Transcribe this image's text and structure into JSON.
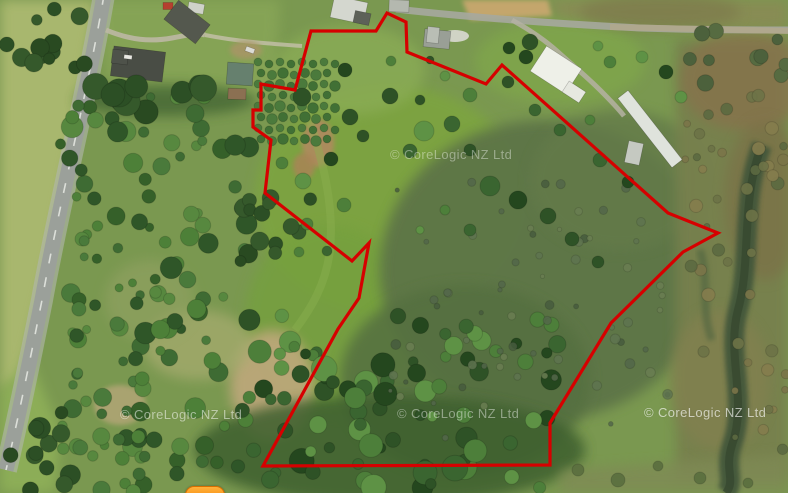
{
  "watermark": {
    "text": "© CoreLogic NZ Ltd"
  },
  "boundary": {
    "color": "#d60000",
    "stroke_width": 3.2,
    "points": [
      [
        311,
        31
      ],
      [
        376,
        31
      ],
      [
        387,
        13
      ],
      [
        406,
        22
      ],
      [
        407,
        52
      ],
      [
        486,
        84
      ],
      [
        502,
        65
      ],
      [
        668,
        213
      ],
      [
        718,
        233
      ],
      [
        683,
        252
      ],
      [
        611,
        323
      ],
      [
        550,
        423
      ],
      [
        550,
        465
      ],
      [
        263,
        466
      ],
      [
        338,
        329
      ],
      [
        359,
        298
      ],
      [
        369,
        243
      ],
      [
        352,
        261
      ],
      [
        265,
        193
      ],
      [
        271,
        140
      ],
      [
        253,
        127
      ],
      [
        253,
        110
      ],
      [
        261,
        110
      ],
      [
        261,
        84
      ],
      [
        295,
        90
      ]
    ]
  },
  "marker_button": {
    "color": "#f57f00"
  }
}
